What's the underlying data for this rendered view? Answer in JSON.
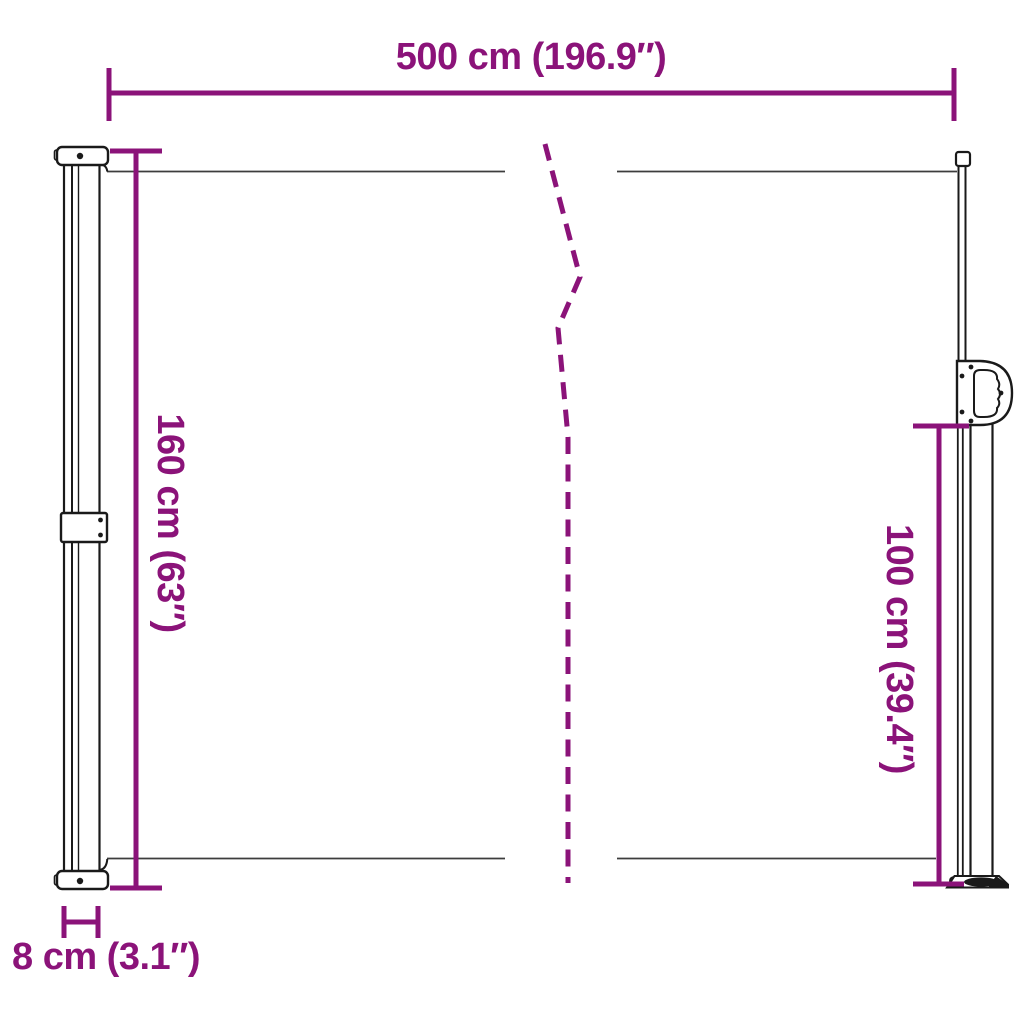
{
  "diagram": {
    "background": "#FFFFFF",
    "accent_color": "#8B1379",
    "outline_color": "#1A1A1A",
    "labels": {
      "width": "500 cm (196.9″)",
      "left_height": "160 cm (63″)",
      "right_height": "100 cm (39.4″)",
      "depth": "8 cm (3.1″)"
    }
  }
}
